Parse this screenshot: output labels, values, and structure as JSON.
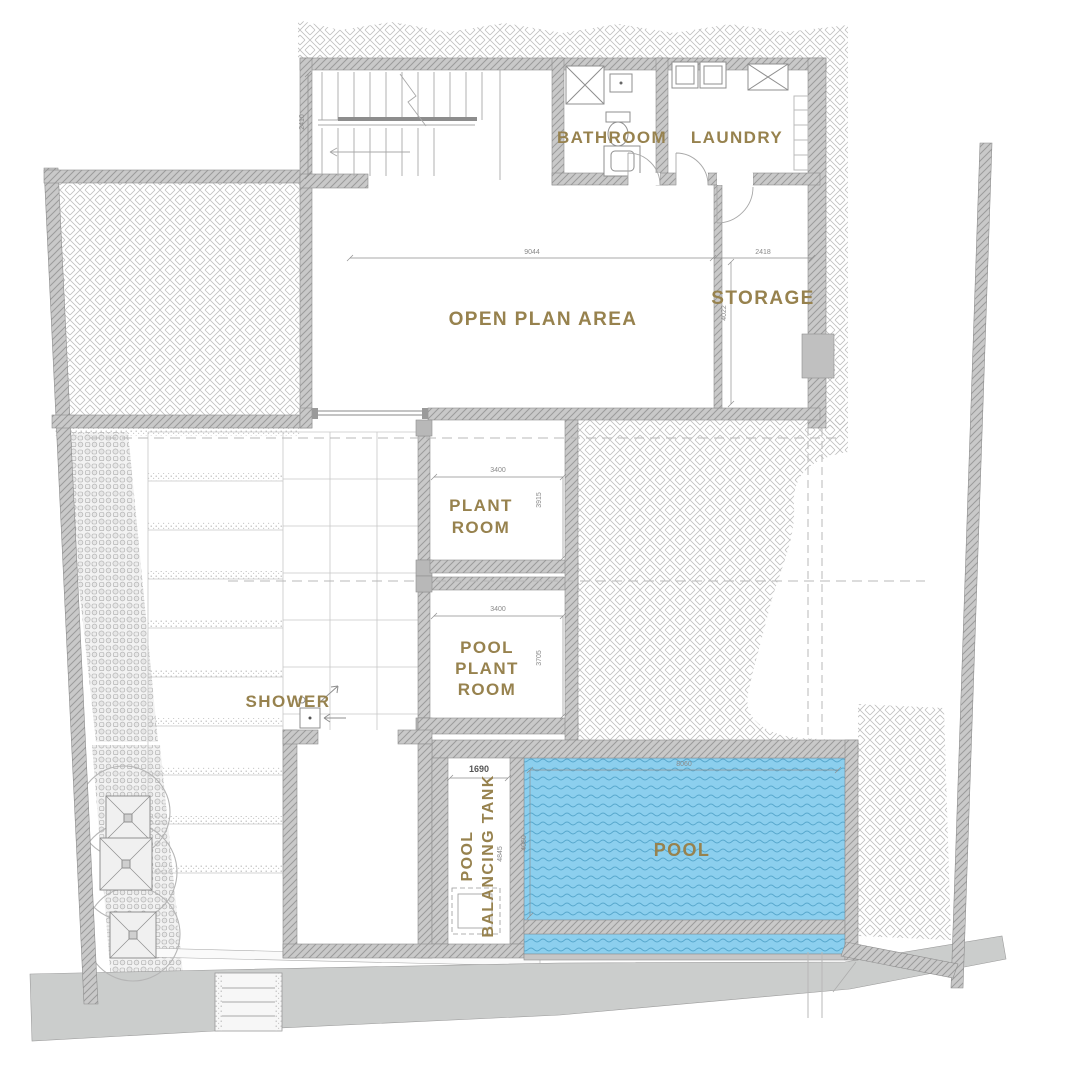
{
  "plan": {
    "rooms": {
      "bathroom": "BATHROOM",
      "laundry": "LAUNDRY",
      "open_plan": "OPEN PLAN AREA",
      "storage": "STORAGE",
      "plant_room": {
        "line1": "PLANT",
        "line2": "ROOM"
      },
      "pool_plant_room": {
        "line1": "POOL",
        "line2": "PLANT",
        "line3": "ROOM"
      },
      "shower": "SHOWER",
      "pool_balancing_tank": {
        "line1": "POOL",
        "line2": "BALANCING TANK"
      },
      "pool": "POOL"
    },
    "dimensions": {
      "open_plan_width": "9044",
      "storage_width": "2418",
      "storage_depth": "4022",
      "stair_depth": "2410",
      "plant_room_width": "3400",
      "plant_room_depth": "3915",
      "pool_plant_room_width": "3400",
      "pool_plant_room_depth": "3705",
      "balancing_tank_width": "1690",
      "balancing_tank_depth": "4845",
      "pool_width": "8060",
      "pool_depth": "4060"
    },
    "colors": {
      "room_label": "#97824e",
      "pool_water": "#8ccfee",
      "pool_wave_lines": "#58a8cd",
      "wall_fill": "#c9c9c9"
    }
  }
}
